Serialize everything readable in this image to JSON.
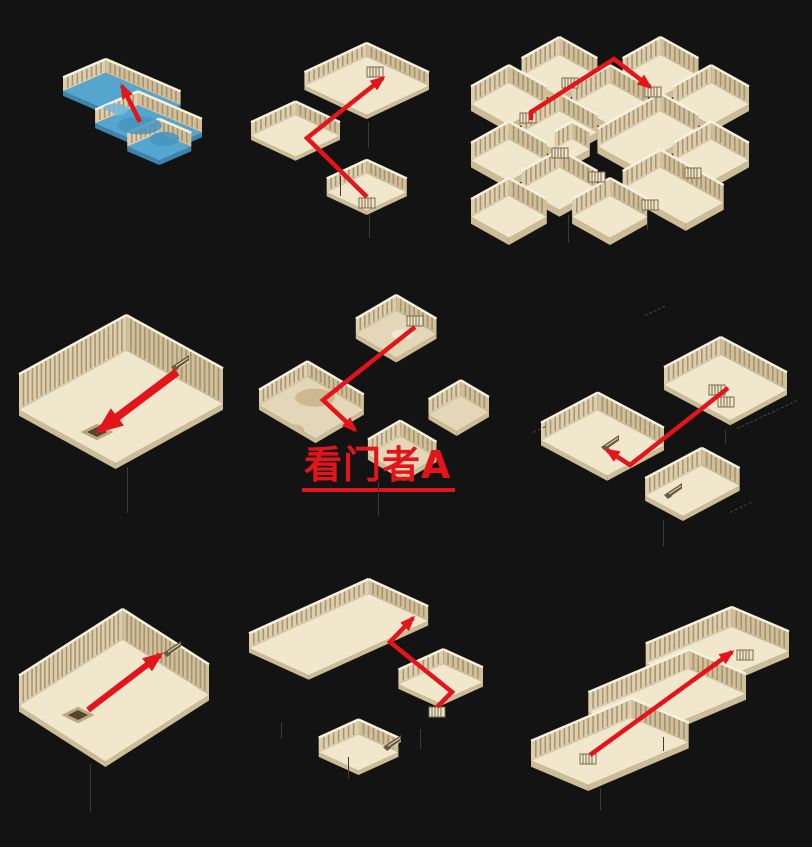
{
  "canvas": {
    "width": 812,
    "height": 847,
    "background": "#131313"
  },
  "annotation": {
    "label": "看门者A",
    "color": "#e3141a",
    "underlined": true
  },
  "palette": {
    "background": "#131313",
    "floor": "#f1e7cc",
    "floor_side": "#cdbd97",
    "wall_nw": "#ddcfae",
    "wall_ne": "#cfbf9a",
    "wall_stripe": "#9c8765",
    "wall_cap": "#f7f2e0",
    "water": "#55a6cf",
    "water_side": "#3e84ab",
    "water_dark": "#4694bd",
    "water_light": "#72b8da",
    "mottle_base": "#e4d7b7",
    "mottle_dark": "#c8b48c",
    "mottle_light": "#f3ecd9",
    "route_red": "#e3141a",
    "deco_dark": "#6a5a42",
    "deco_light": "#efe5c8",
    "shadow_line": "#3a3a3a"
  },
  "maps": [
    {
      "id": "map-1",
      "grid": "row 1 col 1",
      "kind": "flooded water chamber",
      "route": "short arrow pointing up-left toward the wall"
    },
    {
      "id": "map-2",
      "grid": "row 1 col 2",
      "kind": "three linked halls",
      "route": "from bottom room up-left then up-right into big hall"
    },
    {
      "id": "map-3",
      "grid": "row 1 col 3",
      "kind": "lattice of small cells",
      "route": "from left cell up-right then down-right to small cell"
    },
    {
      "id": "map-4",
      "grid": "row 2 col 1",
      "kind": "pillared hall with center pit",
      "route": "thick arrow from stairs down-left into pit"
    },
    {
      "id": "map-5",
      "grid": "row 2 col 2",
      "kind": "weathered cavern rooms",
      "route": "from top room down-left then down-right; gatekeeper A below"
    },
    {
      "id": "map-6",
      "grid": "row 2 col 3",
      "kind": "two terraced halls",
      "route": "from upper room down-left then short hook up-left to stairs"
    },
    {
      "id": "map-7",
      "grid": "row 3 col 1",
      "kind": "long pillared hall with pit",
      "route": "arrow from pit up-right to staircase"
    },
    {
      "id": "map-8",
      "grid": "row 3 col 2",
      "kind": "stepped halls",
      "route": "zigzag from right-room ladder up to top wall"
    },
    {
      "id": "map-9",
      "grid": "row 3 col 3",
      "kind": "long diagonal corridor",
      "route": "long arrow from lower-left ladder to upper-right ladder"
    }
  ]
}
